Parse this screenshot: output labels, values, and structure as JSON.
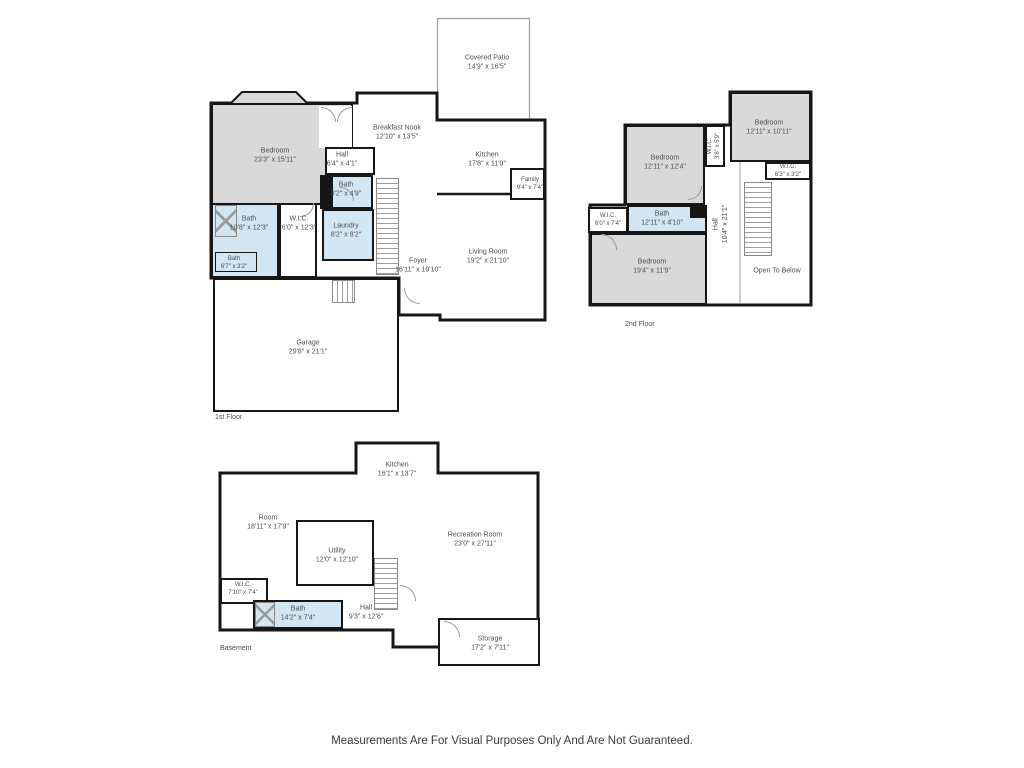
{
  "disclaimer": "Measurements Are For Visual Purposes Only And Are Not Guaranteed.",
  "colors": {
    "wall": "#161616",
    "bedroom_fill": "#d9d9d9",
    "bath_fill": "#d2e5f3",
    "room_fill": "#ffffff",
    "label_text": "#4d4d4d"
  },
  "floors": [
    {
      "label": "1st Floor",
      "rooms": [
        {
          "name": "Covered Patio",
          "dims": "14'9\" x 16'5\""
        },
        {
          "name": "Bedroom",
          "dims": "23'3\" x 15'11\""
        },
        {
          "name": "Breakfast Nook",
          "dims": "12'10\" x 13'5\""
        },
        {
          "name": "Kitchen",
          "dims": "17'8\" x 11'9\""
        },
        {
          "name": "Family",
          "dims": "9'4\" x 7'4\""
        },
        {
          "name": "Hall",
          "dims": "6'4\" x 4'1\""
        },
        {
          "name": "Bath",
          "dims": "8'2\" x 4'9\""
        },
        {
          "name": "Bath",
          "dims": "10'8\" x 12'3\""
        },
        {
          "name": "W.I.C.",
          "dims": "6'0\" x 12'3\""
        },
        {
          "name": "Laundry",
          "dims": "8'2\" x 8'2\""
        },
        {
          "name": "Bath",
          "dims": "6'7\" x 3'2\""
        },
        {
          "name": "Foyer",
          "dims": "16'11\" x 19'10\""
        },
        {
          "name": "Living Room",
          "dims": "19'2\" x 21'10\""
        },
        {
          "name": "Garage",
          "dims": "29'8\" x 21'1\""
        }
      ]
    },
    {
      "label": "2nd Floor",
      "rooms": [
        {
          "name": "Bedroom",
          "dims": "12'11\" x 12'4\""
        },
        {
          "name": "W.I.C.",
          "dims": "3'8\" x 5'9\""
        },
        {
          "name": "Bedroom",
          "dims": "12'11\" x 10'11\""
        },
        {
          "name": "W.I.C.",
          "dims": "6'3\" x 3'2\""
        },
        {
          "name": "W.I.C.",
          "dims": "6'0\" x 7'4\""
        },
        {
          "name": "Bath",
          "dims": "12'11\" x 4'10\""
        },
        {
          "name": "Hall",
          "dims": "10'4\" x 21'1\""
        },
        {
          "name": "Bedroom",
          "dims": "19'4\" x 11'9\""
        },
        {
          "name": "Open To Below",
          "dims": ""
        }
      ]
    },
    {
      "label": "Basement",
      "rooms": [
        {
          "name": "Kitchen",
          "dims": "16'1\" x 13'7\""
        },
        {
          "name": "Room",
          "dims": "18'11\" x 17'9\""
        },
        {
          "name": "Utility",
          "dims": "12'0\" x 12'10\""
        },
        {
          "name": "Recreation Room",
          "dims": "23'0\" x 27'11\""
        },
        {
          "name": "W.I.C.",
          "dims": "7'10\" x 7'4\""
        },
        {
          "name": "Bath",
          "dims": "14'2\" x 7'4\""
        },
        {
          "name": "Hall",
          "dims": "9'3\" x 12'6\""
        },
        {
          "name": "Storage",
          "dims": "17'2\" x 7'11\""
        }
      ]
    }
  ]
}
